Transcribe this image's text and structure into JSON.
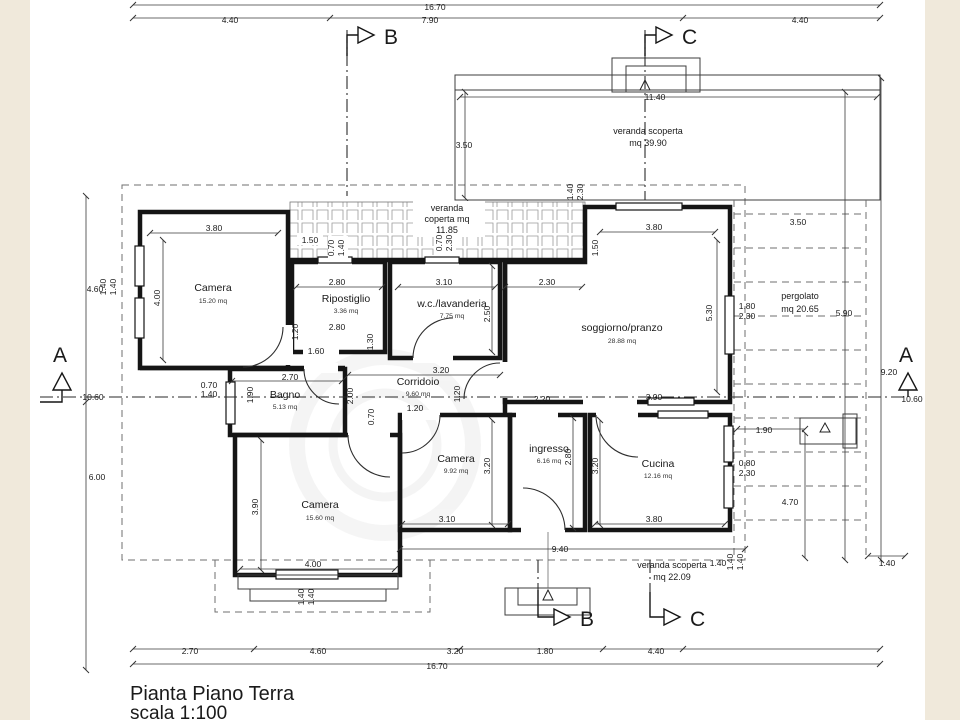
{
  "page": {
    "title_line1": "Pianta Piano Terra",
    "title_line2": "scala 1:100"
  },
  "colors": {
    "paper": "#ffffff",
    "margin": "#f0e9db",
    "wall": "#151515",
    "dim": "#3a3a3a"
  },
  "sections": {
    "a": "A",
    "b": "B",
    "c": "C"
  },
  "outdoor": {
    "veranda_top_l1": "veranda scoperta",
    "veranda_top_l2": "mq 39.90",
    "veranda_cop_l1": "veranda",
    "veranda_cop_l2": "coperta mq",
    "veranda_cop_l3": "11.85",
    "pergolato_l1": "pergolato",
    "pergolato_l2": "mq 20.65",
    "veranda_bot_l1": "veranda scoperta",
    "veranda_bot_l2": "mq 22.09"
  },
  "rooms": {
    "camera1": {
      "name": "Camera",
      "area": "15.20 mq"
    },
    "ripostiglio": {
      "name": "Ripostiglio",
      "area": "3.36 mq"
    },
    "wc": {
      "name": "w.c./lavanderia",
      "area": "7.75 mq"
    },
    "soggiorno": {
      "name": "soggiorno/pranzo",
      "area": "28.88 mq"
    },
    "corridoio": {
      "name": "Corridoio",
      "area": "9.60 mq"
    },
    "bagno": {
      "name": "Bagno",
      "area": "5.13 mq"
    },
    "camera2": {
      "name": "Camera",
      "area": "15.60 mq"
    },
    "camera3": {
      "name": "Camera",
      "area": "9.92 mq"
    },
    "ingresso": {
      "name": "ingresso",
      "area": "6.16 mq"
    },
    "cucina": {
      "name": "Cucina",
      "area": "12.16 mq"
    }
  },
  "dims": {
    "overall_top": "16.70",
    "top_row": [
      "4.40",
      "7.90",
      "4.40"
    ],
    "overall_bottom": "16.70",
    "bottom_row": [
      "2.70",
      "4.60",
      "3.20",
      "1.80",
      "4.40"
    ],
    "left_col": [
      "4.60",
      "10.60",
      "6.00"
    ],
    "inner": [
      "3.80",
      "4.00",
      "1.40",
      "1.40",
      "1.50",
      "0.70",
      "1.40",
      "0.70",
      "2.30",
      "2.80",
      "1.20",
      "2.80",
      "1.30",
      "1.60",
      "2.70",
      "3.10",
      "2.30",
      "2.50",
      "3.20",
      "1.20",
      "2.20",
      "1.90",
      "0.70",
      "1.40",
      "2.00",
      "1.20",
      "0.70",
      "3.80",
      "1.50",
      "5.30",
      "1.40",
      "2.30",
      "3.90",
      "2.80",
      "3.20",
      "3.20",
      "3.10",
      "3.80",
      "3.90",
      "4.00",
      "1.40",
      "1.40",
      "1.40",
      "1.40",
      "1.90",
      "0.80",
      "2.30",
      "4.70",
      "1.40",
      "1.40",
      "3.50",
      "11.40",
      "3.50",
      "5.90",
      "9.20",
      "10.60",
      "1.80",
      "2.30",
      "9.40"
    ]
  }
}
